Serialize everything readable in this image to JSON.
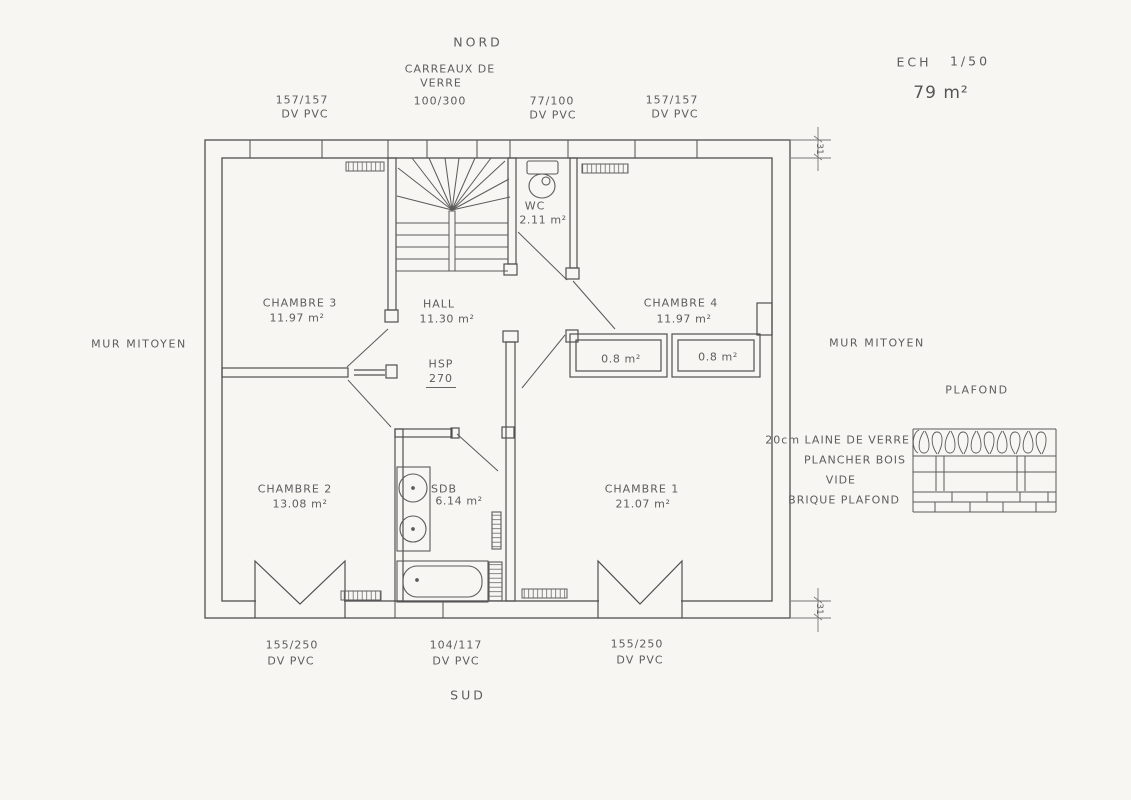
{
  "plan": {
    "north_label": "NORD",
    "south_label": "SUD",
    "scale": {
      "label": "ECH",
      "value": "1/50"
    },
    "total_area": "79 m²",
    "party_wall_left": "MUR MITOYEN",
    "party_wall_right": "MUR MITOYEN",
    "ceiling_height": {
      "label": "HSP",
      "value": "270"
    },
    "wall_dim_top": "31",
    "wall_dim_bottom": "31"
  },
  "north_windows": [
    {
      "size": "157/157",
      "material": "DV PVC"
    },
    {
      "type_line1": "CARREAUX DE",
      "type_line2": "VERRE",
      "size": "100/300"
    },
    {
      "size": "77/100",
      "material": "DV PVC"
    },
    {
      "size": "157/157",
      "material": "DV PVC"
    }
  ],
  "south_windows": [
    {
      "size": "155/250",
      "material": "DV PVC"
    },
    {
      "size": "104/117",
      "material": "DV PVC"
    },
    {
      "size": "155/250",
      "material": "DV PVC"
    }
  ],
  "rooms": {
    "chambre3": {
      "name": "CHAMBRE 3",
      "area": "11.97 m²"
    },
    "hall": {
      "name": "HALL",
      "area": "11.30 m²"
    },
    "wc": {
      "name": "WC",
      "area": "2.11 m²"
    },
    "chambre4": {
      "name": "CHAMBRE 4",
      "area": "11.97 m²"
    },
    "chambre2": {
      "name": "CHAMBRE 2",
      "area": "13.08 m²"
    },
    "sdb": {
      "name": "SDB",
      "area": "6.14 m²"
    },
    "chambre1": {
      "name": "CHAMBRE 1",
      "area": "21.07 m²"
    },
    "closet_left": {
      "area": "0.8 m²"
    },
    "closet_right": {
      "area": "0.8 m²"
    }
  },
  "ceiling_detail": {
    "title": "PLAFOND",
    "layers": [
      "20cm LAINE DE VERRE",
      "PLANCHER BOIS",
      "VIDE",
      "BRIQUE PLAFOND"
    ]
  }
}
